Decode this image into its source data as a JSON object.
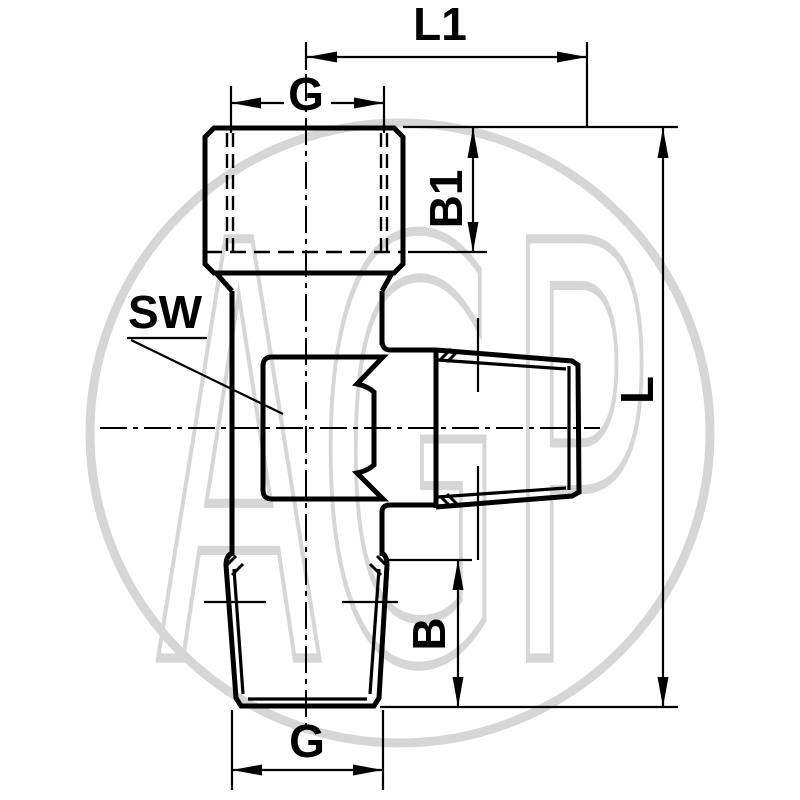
{
  "colors": {
    "line": "#000000",
    "background": "#ffffff",
    "watermark": "#d6d6d6"
  },
  "watermark": {
    "text": "AGP"
  },
  "labels": {
    "l1": "L1",
    "g_top": "G",
    "b1": "B1",
    "sw": "SW",
    "l": "L",
    "b": "B",
    "g_bottom": "G"
  }
}
